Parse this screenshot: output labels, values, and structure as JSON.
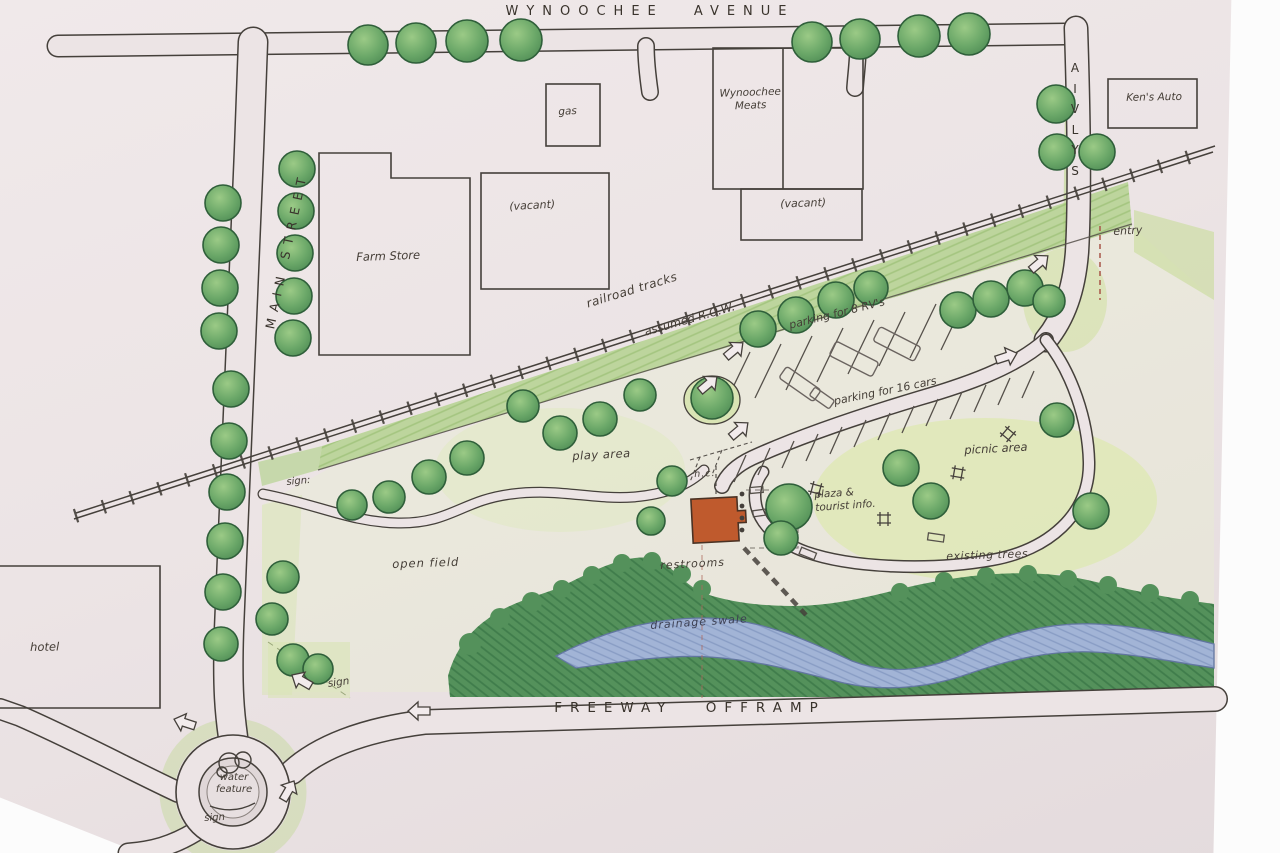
{
  "streets": {
    "wynoochee_avenue": "WYNOOCHEE AVENUE",
    "main_street": "MAIN STREET",
    "sylvia": "SYLVIA",
    "freeway_offramp": "FREEWAY OFFRAMP"
  },
  "buildings": {
    "gas": "gas",
    "vacant_north": "(vacant)",
    "farm_store": "Farm Store",
    "wynoochee_meats": "Wynoochee\nMeats",
    "vacant_east": "(vacant)",
    "kens_auto": "Ken's Auto",
    "hotel": "hotel"
  },
  "site_labels": {
    "railroad_tracks": "railroad tracks",
    "assumed_row": "assumed R.O.W.",
    "rv_parking": "parking for 8 RV's",
    "car_parking": "parking for 16 cars",
    "play_area": "play area",
    "picnic_area": "picnic area",
    "plaza_tourist_info": "plaza &\ntourist info.",
    "hc": "h.c.",
    "restrooms": "restrooms",
    "open_field": "open field",
    "existing_trees": "existing trees",
    "drainage_swale": "drainage swale",
    "water_feature": "water\nfeature",
    "entry": "entry",
    "sign_main_street": "sign:",
    "sign_southwest": "sign",
    "sign_roundabout": "sign"
  },
  "colors": {
    "paper": "#ece4e5",
    "ink": "#45403b",
    "tree_green": "#5d9c5f",
    "lawn_wash": "#dde6bb",
    "dense_trees": "#4f8c55",
    "swale_blue": "#9fb3d6",
    "restroom_roof": "#bf5a2d"
  }
}
